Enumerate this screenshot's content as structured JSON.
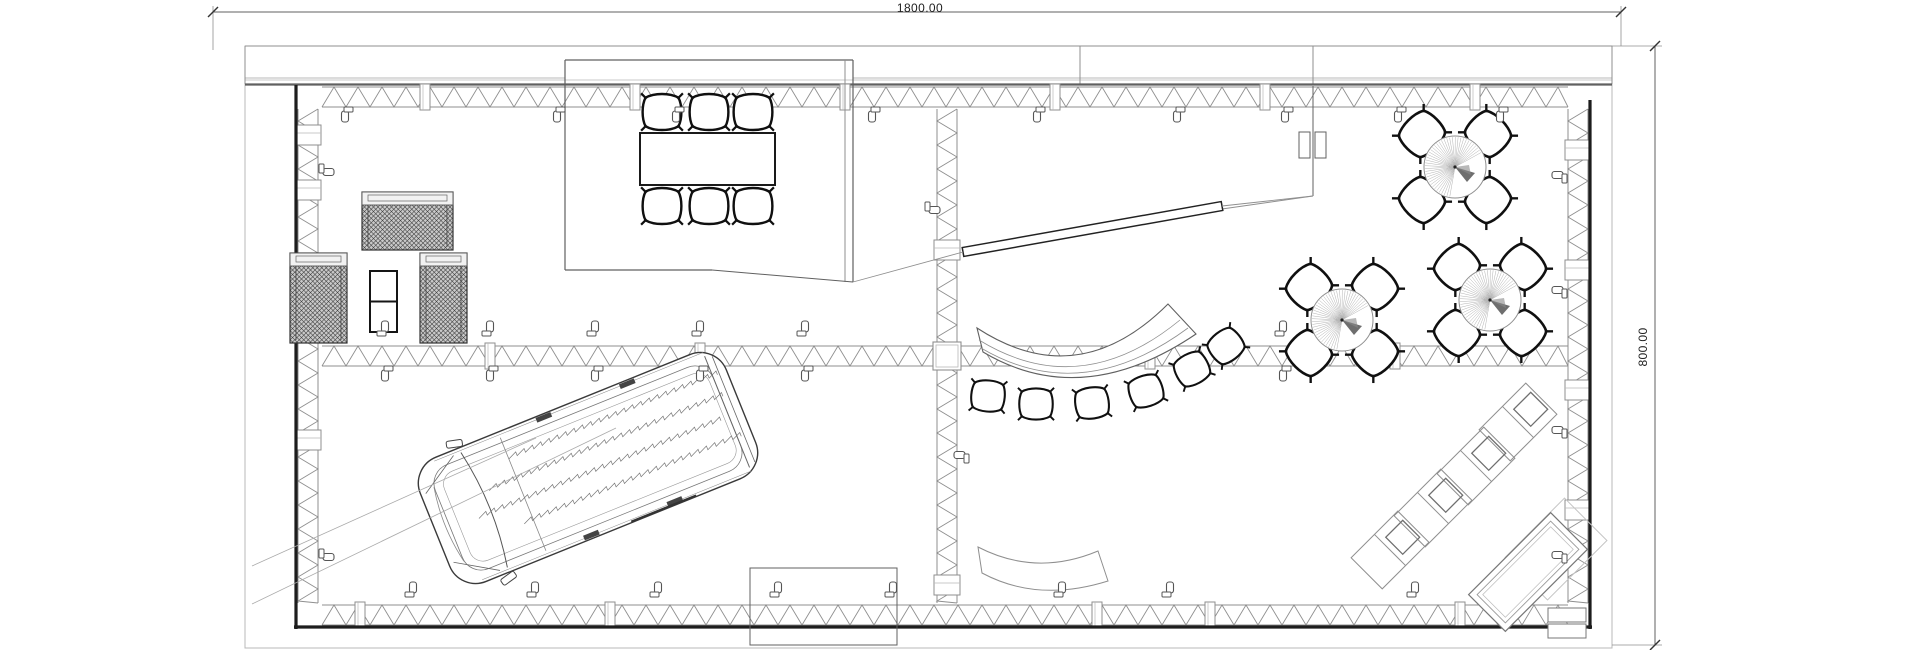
{
  "drawing": {
    "type": "architectural-floor-plan",
    "dimension_width_label": "1800.00",
    "dimension_height_label": "800.00"
  },
  "palette": {
    "wall_dark": "#1d1d1d",
    "line_medium": "#606060",
    "line_light": "#8f8f8f",
    "line_faint": "#b8b8b8",
    "chair_stroke": "#101010",
    "hatch_bg": "#c9c9c9",
    "hatch_line": "#3a3a3a",
    "background": "#ffffff",
    "text": "#1e1e1e"
  },
  "plan": {
    "outer": [
      245,
      46,
      1367,
      602
    ],
    "band": {
      "y0": 46,
      "y1": 84,
      "inner_y": 78,
      "x0": 245,
      "x1": 1612,
      "joints": [
        1080,
        1313
      ],
      "room_gap": [
        565,
        853
      ]
    },
    "walls": {
      "top": {
        "o": "h",
        "a0": 322,
        "a1": 1568,
        "b0": 87,
        "b1": 107,
        "posts": [
          425,
          635,
          845,
          1055,
          1265,
          1475
        ]
      },
      "bottom": {
        "o": "h",
        "a0": 322,
        "a1": 1568,
        "b0": 605,
        "b1": 625,
        "posts": [
          360,
          610,
          1097,
          1210,
          1460
        ]
      },
      "mid_h": {
        "o": "h",
        "a0": 322,
        "a1": 1568,
        "b0": 346,
        "b1": 366,
        "posts": [
          490,
          700,
          1150,
          1395
        ]
      },
      "left": {
        "o": "v",
        "a0": 109,
        "a1": 603,
        "b0": 298,
        "b1": 318,
        "posts": [
          135,
          190,
          440
        ]
      },
      "right": {
        "o": "v",
        "a0": 109,
        "a1": 603,
        "b0": 1568,
        "b1": 1588,
        "posts": [
          150,
          270,
          390,
          510
        ]
      },
      "mid_v": {
        "o": "v",
        "a0": 109,
        "a1": 603,
        "b0": 937,
        "b1": 957,
        "posts": [
          250,
          356,
          585
        ]
      }
    },
    "dark_edges": [
      [
        296,
        85,
        296,
        629
      ],
      [
        294,
        627,
        1592,
        627
      ],
      [
        1590,
        100,
        1590,
        629
      ]
    ],
    "top_edge": [
      245,
      84.5,
      1612,
      84.5
    ],
    "meeting_room": {
      "x": 565,
      "y": 60,
      "w": 288,
      "h": 210,
      "double_x": 845,
      "step_x": 712,
      "step_y": 282
    },
    "partition": {
      "x": 1313,
      "y0": 86,
      "y1": 196,
      "diag": [
        1222,
        209
      ],
      "doors": [
        [
          1299,
          132
        ],
        [
          1315,
          132
        ]
      ]
    },
    "bar": {
      "p0": [
        963,
        252
      ],
      "p1": [
        1222,
        206
      ],
      "hw": 4.5,
      "tail": [
        853,
        282
      ],
      "tail2": [
        1313,
        196
      ]
    },
    "annex_rect": [
      750,
      568,
      147,
      77
    ],
    "guide_lines": [
      [
        252,
        604,
        616,
        428
      ],
      [
        252,
        566,
        536,
        438
      ]
    ],
    "lounge_group": {
      "sofa": [
        362,
        192,
        91,
        58
      ],
      "armchair_left": [
        290,
        253,
        57,
        90
      ],
      "armchair_right": [
        420,
        253,
        47,
        90
      ],
      "coffee_table": [
        370,
        271,
        27,
        61
      ]
    },
    "meeting_set": {
      "table": [
        640,
        133,
        135,
        52
      ],
      "chairs_top_x": [
        662,
        709,
        753
      ],
      "chairs_top_y": 112,
      "chairs_bottom_y": 206,
      "chair_scale": 1.1
    },
    "cafe_tables": {
      "centers": [
        [
          1455,
          167
        ],
        [
          1342,
          320
        ],
        [
          1490,
          300
        ]
      ],
      "radius": 31,
      "chair_offset": 33,
      "chair_scale": 1.18
    },
    "counter_upper": {
      "outline": "M977,328 Q1078,394 1168,304 L1196,334 Q1082,411 983,352 Z",
      "inner1": "M979,340 Q1080,402 1180,320",
      "inner2": "M981,348 Q1081,407 1188,328",
      "stools": [
        [
          988,
          396,
          5
        ],
        [
          1036,
          404,
          0
        ],
        [
          1092,
          403,
          -8
        ],
        [
          1146,
          391,
          -18
        ],
        [
          1192,
          369,
          -28
        ],
        [
          1226,
          346,
          -38
        ]
      ],
      "stool_scale": 0.95
    },
    "bench_lower": "M978,547 Q1036,577 1098,551 L1108,581 Q1038,603 982,573 Z",
    "loungers": {
      "centers": [
        [
          1518,
          422
        ],
        [
          1476,
          466
        ],
        [
          1433,
          508
        ],
        [
          1390,
          550
        ]
      ],
      "rot": -45,
      "w": 66,
      "h": 44
    },
    "corner_desk": {
      "cx": 1528,
      "cy": 572,
      "rot": -45,
      "w": 116,
      "h": 52,
      "ghost": {
        "cx": 1556,
        "cy": 549,
        "w": 84,
        "h": 60
      },
      "steps": [
        [
          1548,
          608,
          38,
          14
        ],
        [
          1548,
          624,
          38,
          14
        ]
      ]
    },
    "van": {
      "cx": 588,
      "cy": 468,
      "rot": -22,
      "len": 330,
      "wid": 134
    },
    "clamps": {
      "top_y": 111,
      "top_x": [
        345,
        557,
        676,
        872,
        1037,
        1177,
        1285,
        1398,
        1500
      ],
      "mid_above_y": 332,
      "mid_below_y": 370,
      "mid_x": [
        385,
        490,
        595,
        700,
        805,
        1283
      ],
      "bottom_y": 593,
      "bottom_x": [
        413,
        535,
        658,
        778,
        893,
        1062,
        1170,
        1415
      ],
      "left_x": 323,
      "left_y": [
        172,
        557
      ],
      "right_x": 1563,
      "right_y": [
        175,
        290,
        430,
        555
      ],
      "vwall": [
        [
          929,
          210,
          -90
        ],
        [
          965,
          455,
          90
        ]
      ]
    },
    "dims": {
      "top_line": [
        213,
        12,
        1621,
        12
      ],
      "top_witness": [
        [
          213,
          6,
          213,
          50
        ],
        [
          1621,
          6,
          1621,
          46
        ]
      ],
      "right_line": [
        1655,
        46,
        1655,
        645
      ],
      "right_witness": [
        [
          1612,
          46,
          1662,
          46
        ],
        [
          1612,
          645,
          1662,
          645
        ]
      ]
    }
  }
}
